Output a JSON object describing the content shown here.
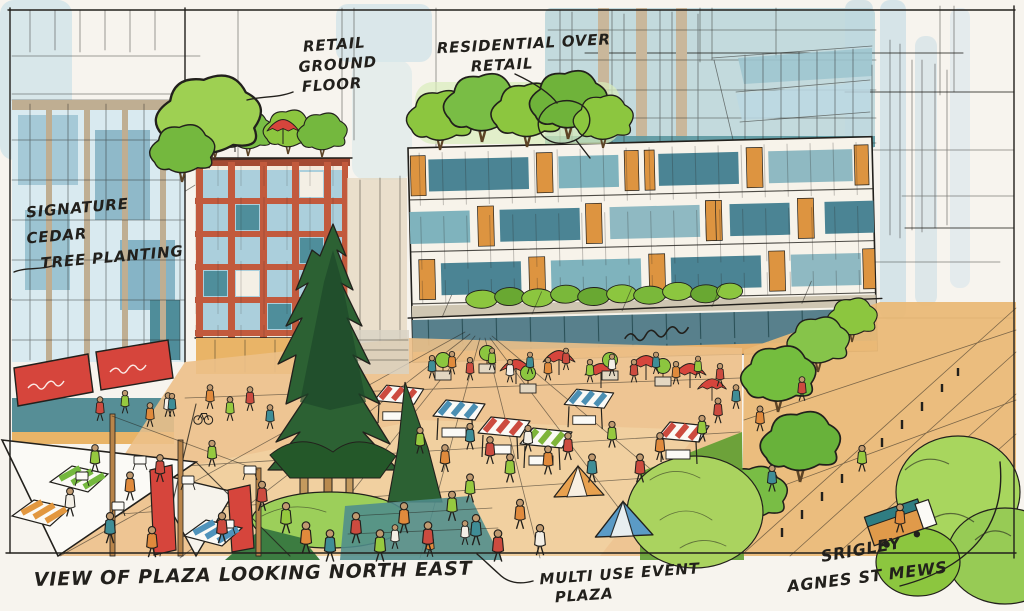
{
  "annotations": {
    "retail": {
      "line1": "RETAIL",
      "line2": "GROUND",
      "line3": "FLOOR"
    },
    "residential": {
      "line1": "RESIDENTIAL OVER",
      "line2": "RETAIL"
    },
    "cedar": {
      "line1": "SIGNATURE",
      "line2": "CEDAR",
      "line3": "TREE PLANTING"
    },
    "plaza": {
      "line1": "MULTI USE EVENT",
      "line2": "PLAZA"
    },
    "caption": "VIEW OF PLAZA LOOKING NORTH EAST",
    "signature": "SRIGLEY",
    "street": "AGNES ST MEWS"
  },
  "palette": {
    "paper": "#f7f4ee",
    "ink": "#22201c",
    "sky_blue": "#c3dde7",
    "glass_blue": "#a5c9d7",
    "window_teal": "#47808e",
    "brick_red": "#c25a3d",
    "panel_orange": "#dd9440",
    "awning_red": "#d6453c",
    "foliage_green": "#8cc63f",
    "cedar_green": "#2c6133",
    "ground_tan": "#ecc088",
    "wood_tan": "#b9854a"
  }
}
